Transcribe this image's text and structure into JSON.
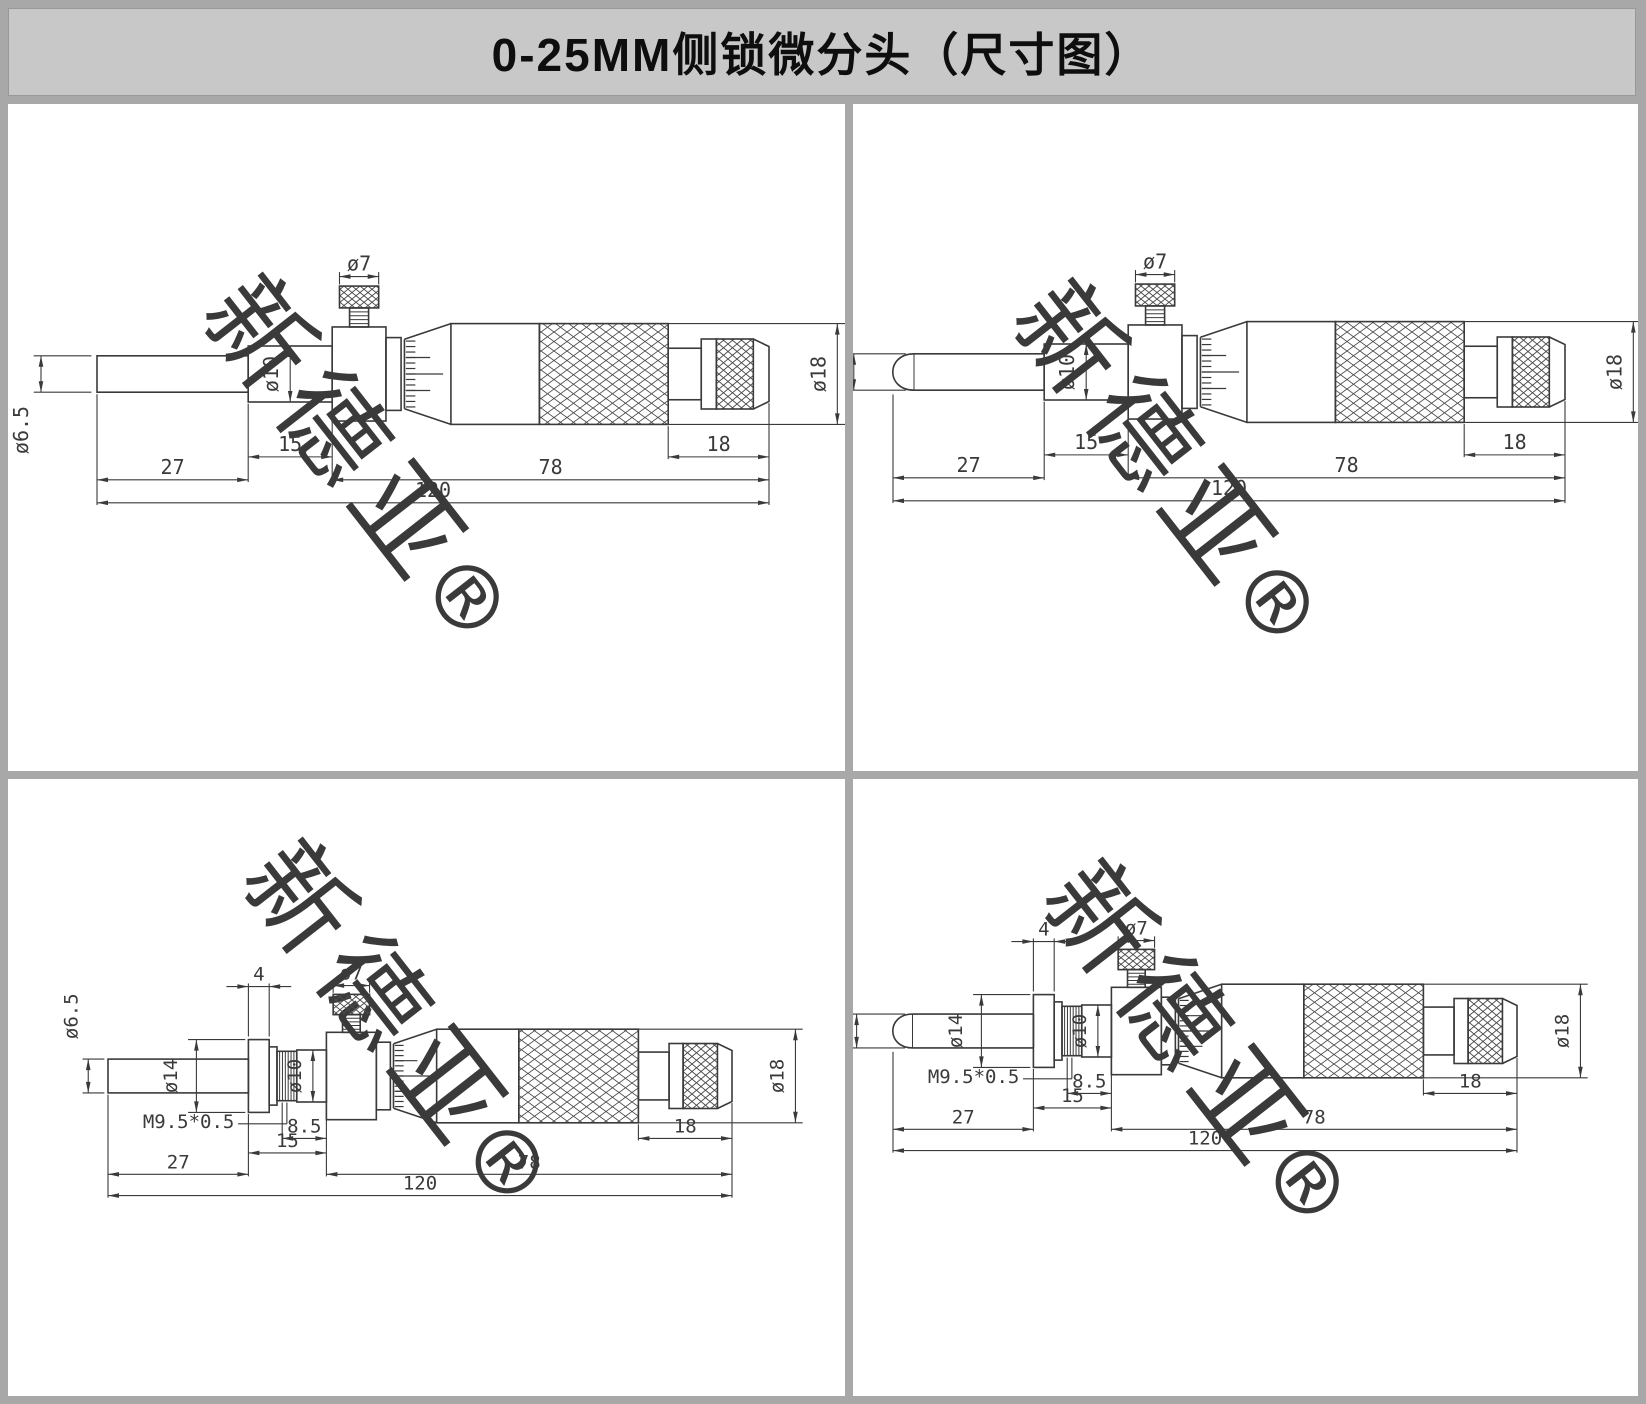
{
  "title": "0-25MM侧锁微分头（尺寸图）",
  "watermark": "新德亚®",
  "colors": {
    "frame": "#a8a8a8",
    "title_bg": "#c8c8c8",
    "panel_bg": "#ffffff",
    "line": "#3a3a3a"
  },
  "panels": [
    {
      "id": "top-left",
      "variant": "flat-tip",
      "mounting_nut": false,
      "labels": {
        "dia_tip": "ø6.5",
        "dia_stem": "ø10",
        "dia_knob": "ø7",
        "dia_thimble": "ø18",
        "len_stem": "15",
        "len_spindle": "27",
        "len_body": "78",
        "len_cap": "18",
        "len_total": "120"
      }
    },
    {
      "id": "top-right",
      "variant": "ball-tip",
      "mounting_nut": false,
      "labels": {
        "dia_tip": "ø6.5",
        "dia_stem": "ø10",
        "dia_knob": "ø7",
        "dia_thimble": "ø18",
        "len_stem": "15",
        "len_spindle": "27",
        "len_body": "78",
        "len_cap": "18",
        "len_total": "120"
      }
    },
    {
      "id": "bottom-left",
      "variant": "flat-tip",
      "mounting_nut": true,
      "labels": {
        "dia_tip": "ø6.5",
        "dia_stem": "ø10",
        "dia_knob": "ø7",
        "dia_thimble": "ø18",
        "dia_flange": "ø14",
        "thread": "M9.5*0.5",
        "len_flange": "4",
        "len_collar": "8.5",
        "len_stem": "15",
        "len_spindle": "27",
        "len_body": "78",
        "len_cap": "18",
        "len_total": "120"
      }
    },
    {
      "id": "bottom-right",
      "variant": "ball-tip",
      "mounting_nut": true,
      "labels": {
        "dia_tip": "ø6.5",
        "dia_stem": "ø10",
        "dia_knob": "ø7",
        "dia_thimble": "ø18",
        "dia_flange": "ø14",
        "thread": "M9.5*0.5",
        "len_flange": "4",
        "len_collar": "8.5",
        "len_stem": "15",
        "len_spindle": "27",
        "len_body": "78",
        "len_cap": "18",
        "len_total": "120"
      }
    }
  ]
}
